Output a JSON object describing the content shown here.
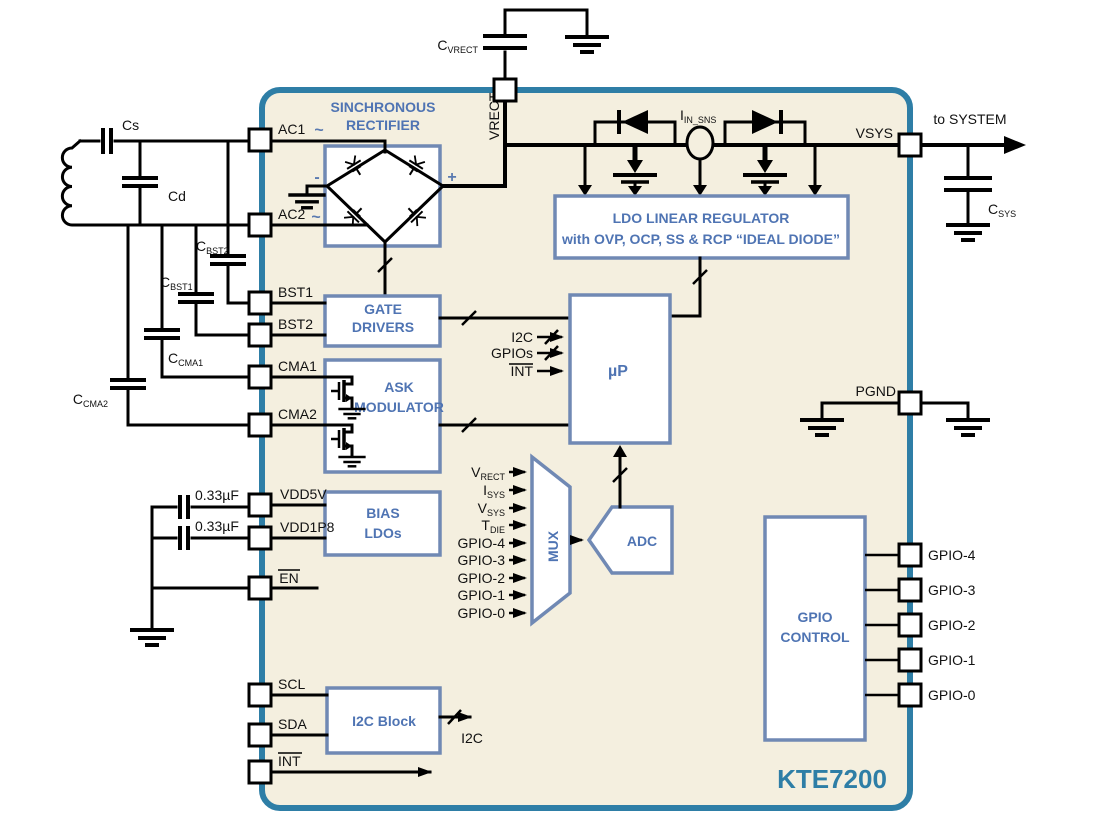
{
  "chip": {
    "name": "KTE7200",
    "colors": {
      "border": "#2e7ea6",
      "fill": "#f4efdf",
      "block_border": "#7089b4",
      "block_text": "#4f74b3",
      "wire": "#000000"
    }
  },
  "blocks": {
    "rectifier": {
      "title1": "SINCHRONOUS",
      "title2": "RECTIFIER",
      "plus": "+",
      "minus": "-",
      "tilde_ac1": "~",
      "tilde_ac2": "~"
    },
    "gate_drivers": {
      "line1": "GATE",
      "line2": "DRIVERS"
    },
    "ask_modulator": {
      "line1": "ASK",
      "line2": "MODULATOR"
    },
    "bias_ldos": {
      "line1": "BIAS",
      "line2": "LDOs"
    },
    "i2c_block": {
      "label": "I2C Block"
    },
    "ldo": {
      "line1": "LDO LINEAR REGULATOR",
      "line2": "with OVP, OCP, SS & RCP “IDEAL DIODE”"
    },
    "microprocessor": {
      "label": "µP"
    },
    "mux": {
      "label": "MUX"
    },
    "adc": {
      "label": "ADC"
    },
    "gpio_control": {
      "line1": "GPIO",
      "line2": "CONTROL"
    }
  },
  "pins": {
    "left": [
      "AC1",
      "AC2",
      "BST1",
      "BST2",
      "CMA1",
      "CMA2",
      "VDD5V",
      "VDD1P8",
      "EN",
      "SCL",
      "SDA",
      "INT"
    ],
    "top": {
      "vrect": "VRECT"
    },
    "right": {
      "vsys": "VSYS",
      "pgnd": "PGND",
      "gpio": [
        "GPIO-4",
        "GPIO-3",
        "GPIO-2",
        "GPIO-1",
        "GPIO-0"
      ]
    }
  },
  "mux_inputs": [
    {
      "main": "V",
      "sub": "RECT"
    },
    {
      "main": "I",
      "sub": "SYS"
    },
    {
      "main": "V",
      "sub": "SYS"
    },
    {
      "main": "T",
      "sub": "DIE"
    },
    {
      "main": "GPIO-4",
      "sub": ""
    },
    {
      "main": "GPIO-3",
      "sub": ""
    },
    {
      "main": "GPIO-2",
      "sub": ""
    },
    {
      "main": "GPIO-1",
      "sub": ""
    },
    {
      "main": "GPIO-0",
      "sub": ""
    }
  ],
  "signals": {
    "i2c_up": "I2C",
    "gpios_up": "GPIOs",
    "int_up": "INT",
    "i2c_out": "I2C",
    "to_system": "to SYSTEM",
    "iin_sns": {
      "main": "I",
      "sub": "IN_SNS"
    }
  },
  "external": {
    "cs": "Cs",
    "cd": "Cd",
    "cbst2": {
      "main": "C",
      "sub": "BST2"
    },
    "cbst1": {
      "main": "C",
      "sub": "BST1"
    },
    "ccma1": {
      "main": "C",
      "sub": "CMA1"
    },
    "ccma2": {
      "main": "C",
      "sub": "CMA2"
    },
    "cvrect": {
      "main": "C",
      "sub": "VRECT"
    },
    "csys": {
      "main": "C",
      "sub": "SYS"
    },
    "cap_vdd5v": "0.33µF",
    "cap_vdd1p8": "0.33µF"
  }
}
